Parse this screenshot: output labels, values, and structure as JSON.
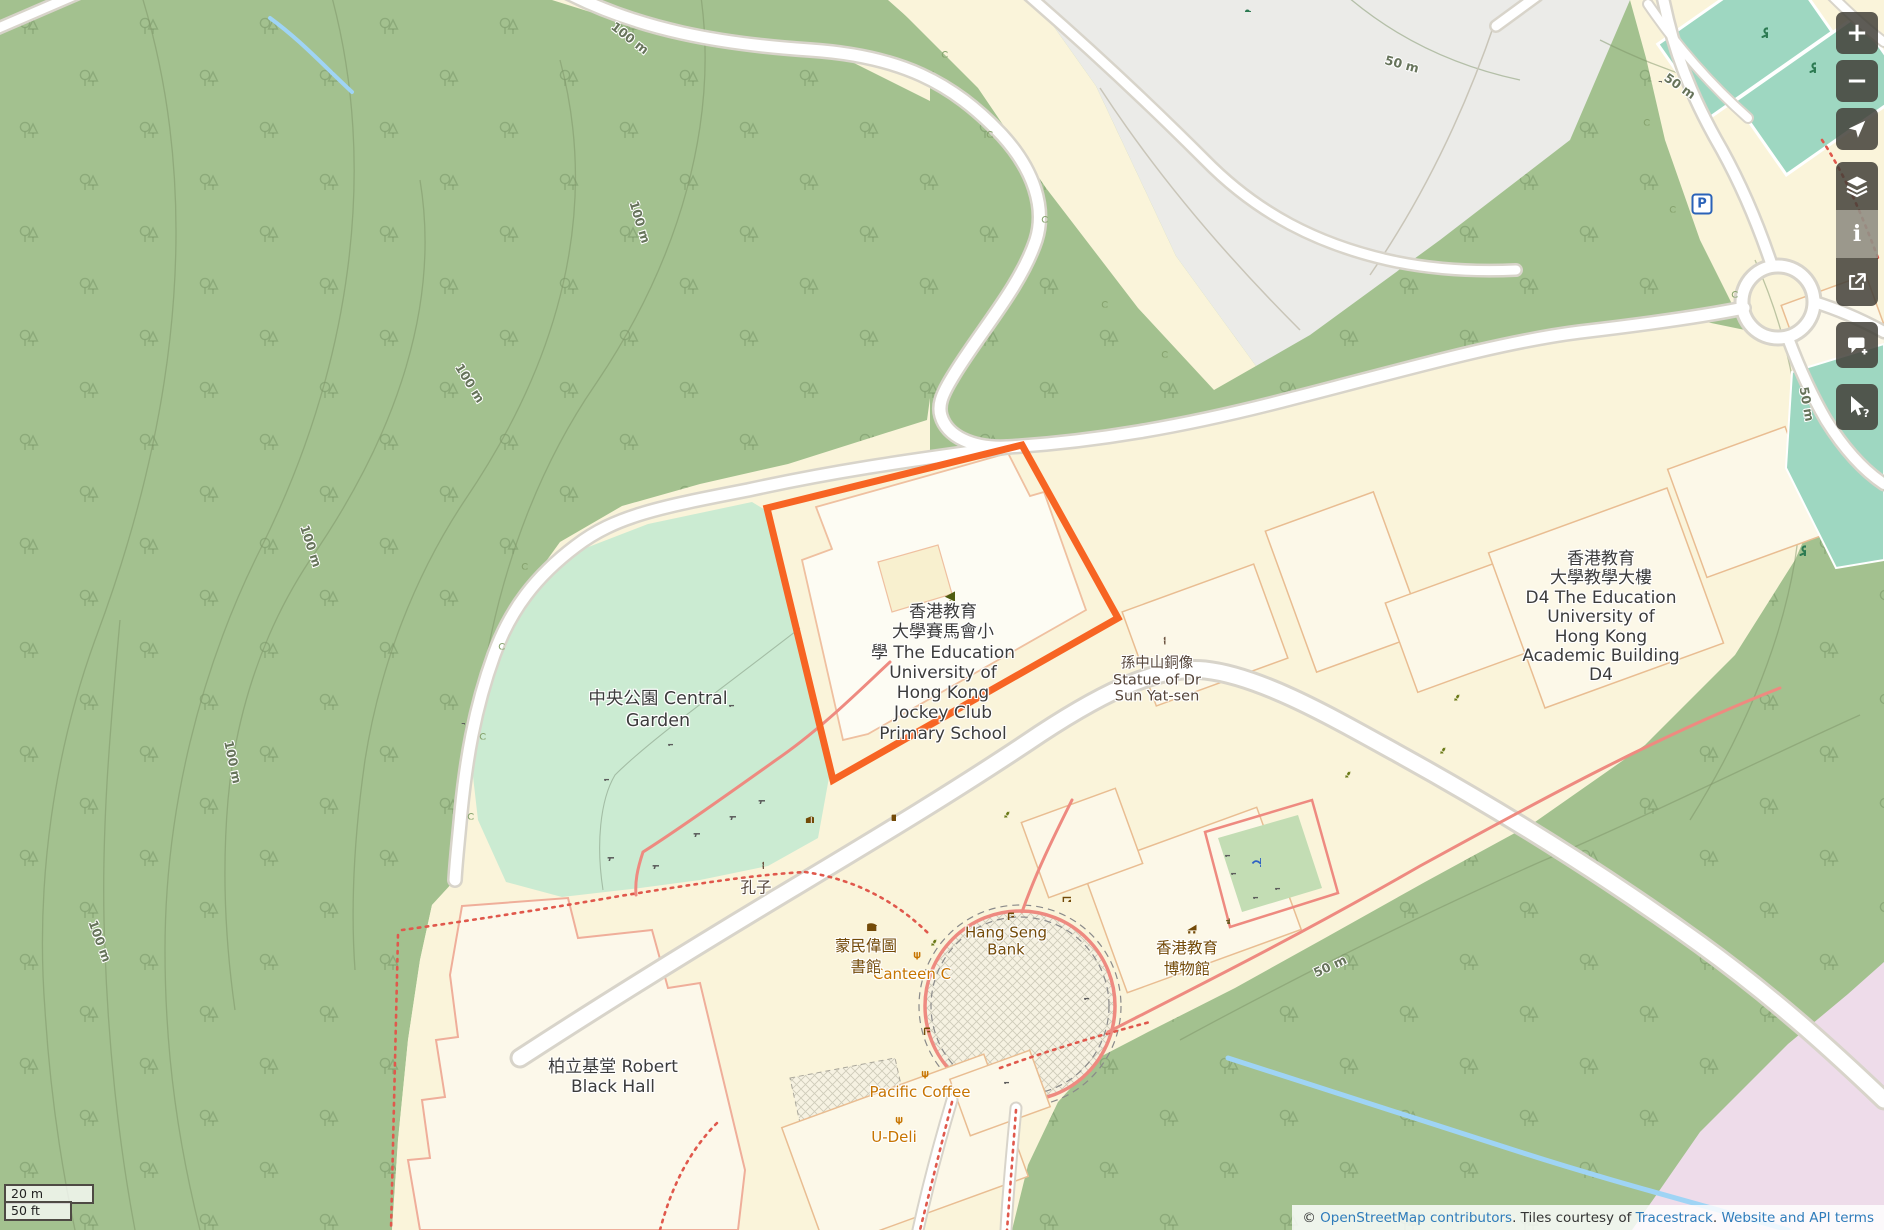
{
  "map": {
    "selection": {
      "color": "#f76423",
      "points": [
        [
          1022,
          445
        ],
        [
          1118,
          618
        ],
        [
          833,
          780
        ],
        [
          767,
          508
        ]
      ]
    },
    "labels": [
      {
        "name": "central-garden",
        "x": 658,
        "y": 710,
        "fs": 17.5,
        "lh": 22,
        "color": "#3c3c3c",
        "lines": [
          "中央公園 Central",
          "Garden"
        ]
      },
      {
        "name": "primary-school",
        "x": 943,
        "y": 673,
        "fs": 17,
        "lh": 20.3,
        "color": "#3c3c3c",
        "lines": [
          "香港教育",
          "大學賽馬會小",
          "學 The Education",
          "University of",
          "Hong Kong",
          "Jockey Club",
          "Primary School"
        ]
      },
      {
        "name": "sun-yat-sen-statue",
        "x": 1157,
        "y": 680,
        "fs": 14.5,
        "lh": 16.5,
        "color": "#55453a",
        "lines": [
          "孫中山銅像",
          "Statue of Dr",
          "Sun Yat-sen"
        ]
      },
      {
        "name": "academic-building-d4",
        "x": 1601,
        "y": 618,
        "fs": 17,
        "lh": 19.4,
        "color": "#3c3c3c",
        "lines": [
          "香港教育",
          "大學教學大樓",
          "D4 The Education",
          "University of",
          "Hong Kong",
          "Academic Building",
          "D4"
        ]
      },
      {
        "name": "robert-black-hall",
        "x": 613,
        "y": 1077,
        "fs": 17,
        "lh": 20,
        "color": "#3c3c3c",
        "lines": [
          "柏立基堂 Robert",
          "Black Hall"
        ]
      },
      {
        "name": "hang-seng-bank",
        "x": 1006,
        "y": 941,
        "fs": 15,
        "lh": 16.5,
        "color": "#734a08",
        "lines": [
          "Hang Seng",
          "Bank"
        ]
      },
      {
        "name": "canteen-c",
        "x": 912,
        "y": 974,
        "fs": 15,
        "lh": 16,
        "color": "#c77400",
        "lines": [
          "Canteen C"
        ]
      },
      {
        "name": "pacific-coffee",
        "x": 920,
        "y": 1092,
        "fs": 15,
        "lh": 16,
        "color": "#c77400",
        "lines": [
          "Pacific Coffee"
        ]
      },
      {
        "name": "u-deli",
        "x": 894,
        "y": 1137,
        "fs": 15,
        "lh": 16,
        "color": "#c77400",
        "lines": [
          "U-Deli"
        ]
      },
      {
        "name": "library",
        "x": 866,
        "y": 957,
        "fs": 15.5,
        "lh": 21,
        "color": "#734a08",
        "lines": [
          "蒙民偉圖",
          "書館"
        ]
      },
      {
        "name": "education-museum",
        "x": 1187,
        "y": 959,
        "fs": 15.5,
        "lh": 21,
        "color": "#734a08",
        "lines": [
          "香港教育",
          "博物館"
        ]
      },
      {
        "name": "confucius",
        "x": 756,
        "y": 888,
        "fs": 15.5,
        "lh": 17,
        "color": "#55453a",
        "lines": [
          "孔子"
        ]
      }
    ],
    "contour_labels": [
      {
        "text": "100 m",
        "x": 630,
        "y": 38,
        "rot": 38
      },
      {
        "text": "100 m",
        "x": 640,
        "y": 222,
        "rot": 73
      },
      {
        "text": "100 m",
        "x": 470,
        "y": 383,
        "rot": 58
      },
      {
        "text": "100 m",
        "x": 311,
        "y": 546,
        "rot": 72
      },
      {
        "text": "100 m",
        "x": 233,
        "y": 762,
        "rot": 78
      },
      {
        "text": "100 m",
        "x": 100,
        "y": 941,
        "rot": 70
      },
      {
        "text": "50 m",
        "x": 1402,
        "y": 64,
        "rot": 15
      },
      {
        "text": "50 m",
        "x": 1680,
        "y": 86,
        "rot": 35
      },
      {
        "text": "50 m",
        "x": 1807,
        "y": 404,
        "rot": 80
      },
      {
        "text": "50 m",
        "x": 1330,
        "y": 966,
        "rot": -25
      }
    ],
    "icons": [
      {
        "sym": "school",
        "x": 943,
        "y": 589,
        "s": 24,
        "c": "#4f5c10"
      },
      {
        "sym": "statue",
        "x": 1157,
        "y": 636,
        "s": 17,
        "c": "#6b5340"
      },
      {
        "sym": "statue",
        "x": 756,
        "y": 861,
        "s": 16,
        "c": "#6b5340"
      },
      {
        "sym": "book",
        "x": 866,
        "y": 920,
        "s": 22,
        "c": "#734a08"
      },
      {
        "sym": "museum",
        "x": 1186,
        "y": 923,
        "s": 21,
        "c": "#734a08"
      },
      {
        "sym": "fork",
        "x": 912,
        "y": 951,
        "s": 17,
        "c": "#c77400"
      },
      {
        "sym": "fork",
        "x": 920,
        "y": 1070,
        "s": 17,
        "c": "#c77400"
      },
      {
        "sym": "fork",
        "x": 894,
        "y": 1116,
        "s": 17,
        "c": "#c77400"
      },
      {
        "sym": "atm",
        "x": 1005,
        "y": 911,
        "s": 18,
        "c": "#734a08"
      },
      {
        "sym": "atm",
        "x": 921,
        "y": 1026,
        "s": 18,
        "c": "#734a08"
      },
      {
        "sym": "banknote",
        "x": 1062,
        "y": 893,
        "s": 18,
        "c": "#734a08"
      },
      {
        "sym": "basket",
        "x": 1090,
        "y": 919,
        "s": 17,
        "c": "#9a5bb5"
      },
      {
        "sym": "recycle",
        "x": 1451,
        "y": 692,
        "s": 17,
        "c": "#6b7a18"
      },
      {
        "sym": "recycle",
        "x": 1437,
        "y": 745,
        "s": 17,
        "c": "#6b7a18"
      },
      {
        "sym": "recycle",
        "x": 1342,
        "y": 769,
        "s": 17,
        "c": "#6b7a18"
      },
      {
        "sym": "recycle",
        "x": 1001,
        "y": 809,
        "s": 17,
        "c": "#6b7a18"
      },
      {
        "sym": "recycle",
        "x": 928,
        "y": 937,
        "s": 17,
        "c": "#6b7a18"
      },
      {
        "sym": "bench",
        "x": 666,
        "y": 739,
        "s": 14,
        "c": "#5c5c5c"
      },
      {
        "sym": "bench",
        "x": 602,
        "y": 774,
        "s": 14,
        "c": "#5c5c5c"
      },
      {
        "sym": "bench",
        "x": 727,
        "y": 700,
        "s": 14,
        "c": "#5c5c5c"
      },
      {
        "sym": "bench",
        "x": 1223,
        "y": 850,
        "s": 14,
        "c": "#5c5c5c"
      },
      {
        "sym": "bench",
        "x": 1229,
        "y": 868,
        "s": 14,
        "c": "#5c5c5c"
      },
      {
        "sym": "bench",
        "x": 1273,
        "y": 883,
        "s": 14,
        "c": "#5c5c5c"
      },
      {
        "sym": "bench",
        "x": 1251,
        "y": 892,
        "s": 14,
        "c": "#5c5c5c"
      },
      {
        "sym": "bench",
        "x": 1082,
        "y": 993,
        "s": 14,
        "c": "#5c5c5c"
      },
      {
        "sym": "bench",
        "x": 1002,
        "y": 1077,
        "s": 14,
        "c": "#5c5c5c"
      },
      {
        "sym": "picnic",
        "x": 757,
        "y": 796,
        "s": 16,
        "c": "#5c5c5c"
      },
      {
        "sym": "picnic",
        "x": 728,
        "y": 812,
        "s": 16,
        "c": "#5c5c5c"
      },
      {
        "sym": "picnic",
        "x": 692,
        "y": 829,
        "s": 16,
        "c": "#5c5c5c"
      },
      {
        "sym": "picnic",
        "x": 651,
        "y": 861,
        "s": 16,
        "c": "#5c5c5c"
      },
      {
        "sym": "picnic",
        "x": 606,
        "y": 853,
        "s": 16,
        "c": "#5c5c5c"
      },
      {
        "sym": "map",
        "x": 805,
        "y": 814,
        "s": 18,
        "c": "#734a08"
      },
      {
        "sym": "board",
        "x": 888,
        "y": 813,
        "s": 16,
        "c": "#734a08"
      },
      {
        "sym": "fountain",
        "x": 1251,
        "y": 857,
        "s": 20,
        "c": "#2f62c4"
      },
      {
        "sym": "trash",
        "x": 1223,
        "y": 917,
        "s": 14,
        "c": "#6a5a20"
      },
      {
        "sym": "player",
        "x": 1757,
        "y": 27,
        "s": 22,
        "c": "#2c7a52"
      },
      {
        "sym": "player",
        "x": 1805,
        "y": 62,
        "s": 22,
        "c": "#2c7a52"
      },
      {
        "sym": "player",
        "x": 1795,
        "y": 545,
        "s": 22,
        "c": "#2c7a52"
      },
      {
        "sym": "gate",
        "x": 458,
        "y": 718,
        "s": 14,
        "c": "#555555"
      },
      {
        "sym": "gate",
        "x": 1655,
        "y": 76,
        "s": 14,
        "c": "#555555"
      },
      {
        "sym": "dumbbell",
        "x": 1243,
        "y": 4,
        "s": 16,
        "c": "#2c7a52"
      },
      {
        "sym": "tree",
        "x": 520,
        "y": 562,
        "s": 15,
        "c": "#87a36e"
      },
      {
        "sym": "tree",
        "x": 497,
        "y": 642,
        "s": 15,
        "c": "#87a36e"
      },
      {
        "sym": "tree",
        "x": 478,
        "y": 732,
        "s": 15,
        "c": "#87a36e"
      },
      {
        "sym": "tree",
        "x": 466,
        "y": 812,
        "s": 15,
        "c": "#87a36e"
      },
      {
        "sym": "tree",
        "x": 940,
        "y": 50,
        "s": 15,
        "c": "#87a36e"
      },
      {
        "sym": "tree",
        "x": 985,
        "y": 130,
        "s": 15,
        "c": "#87a36e"
      },
      {
        "sym": "tree",
        "x": 1040,
        "y": 215,
        "s": 15,
        "c": "#87a36e"
      },
      {
        "sym": "tree",
        "x": 1100,
        "y": 300,
        "s": 15,
        "c": "#87a36e"
      },
      {
        "sym": "tree",
        "x": 1160,
        "y": 350,
        "s": 15,
        "c": "#87a36e"
      },
      {
        "sym": "tree",
        "x": 1642,
        "y": 118,
        "s": 15,
        "c": "#87a36e"
      },
      {
        "sym": "tree",
        "x": 1668,
        "y": 205,
        "s": 15,
        "c": "#87a36e"
      },
      {
        "sym": "tree",
        "x": 1730,
        "y": 290,
        "s": 15,
        "c": "#87a36e"
      }
    ],
    "parking_label": "P"
  },
  "controls": {
    "zoom_in": "+",
    "zoom_out": "−",
    "info": "i",
    "query_mark": "?"
  },
  "scale": {
    "metric": "20 m",
    "imperial": "50 ft"
  },
  "attribution": {
    "copyright": "© ",
    "osm_link": "OpenStreetMap contributors",
    "middle": ". Tiles courtesy of ",
    "tracestrack_link": "Tracestrack",
    "separator": ". ",
    "terms_link": "Website and API terms"
  },
  "colors": {
    "selection": "#f76423",
    "forest": "#a3c18f",
    "garden": "#cbebd2",
    "campus": "#faf4da",
    "building_fill": "#fcf8e8",
    "building_stroke": "#e9bd92",
    "gray_area": "#ebebe8",
    "water": "#9fd4f5",
    "court": "#9ed7c1",
    "pink_area": "#eedcea",
    "road_casing": "#d8d4ca",
    "path_red": "#e0584c",
    "path_salmon": "#ee8a80",
    "amenity_brown": "#734a08",
    "food_orange": "#c77400"
  }
}
